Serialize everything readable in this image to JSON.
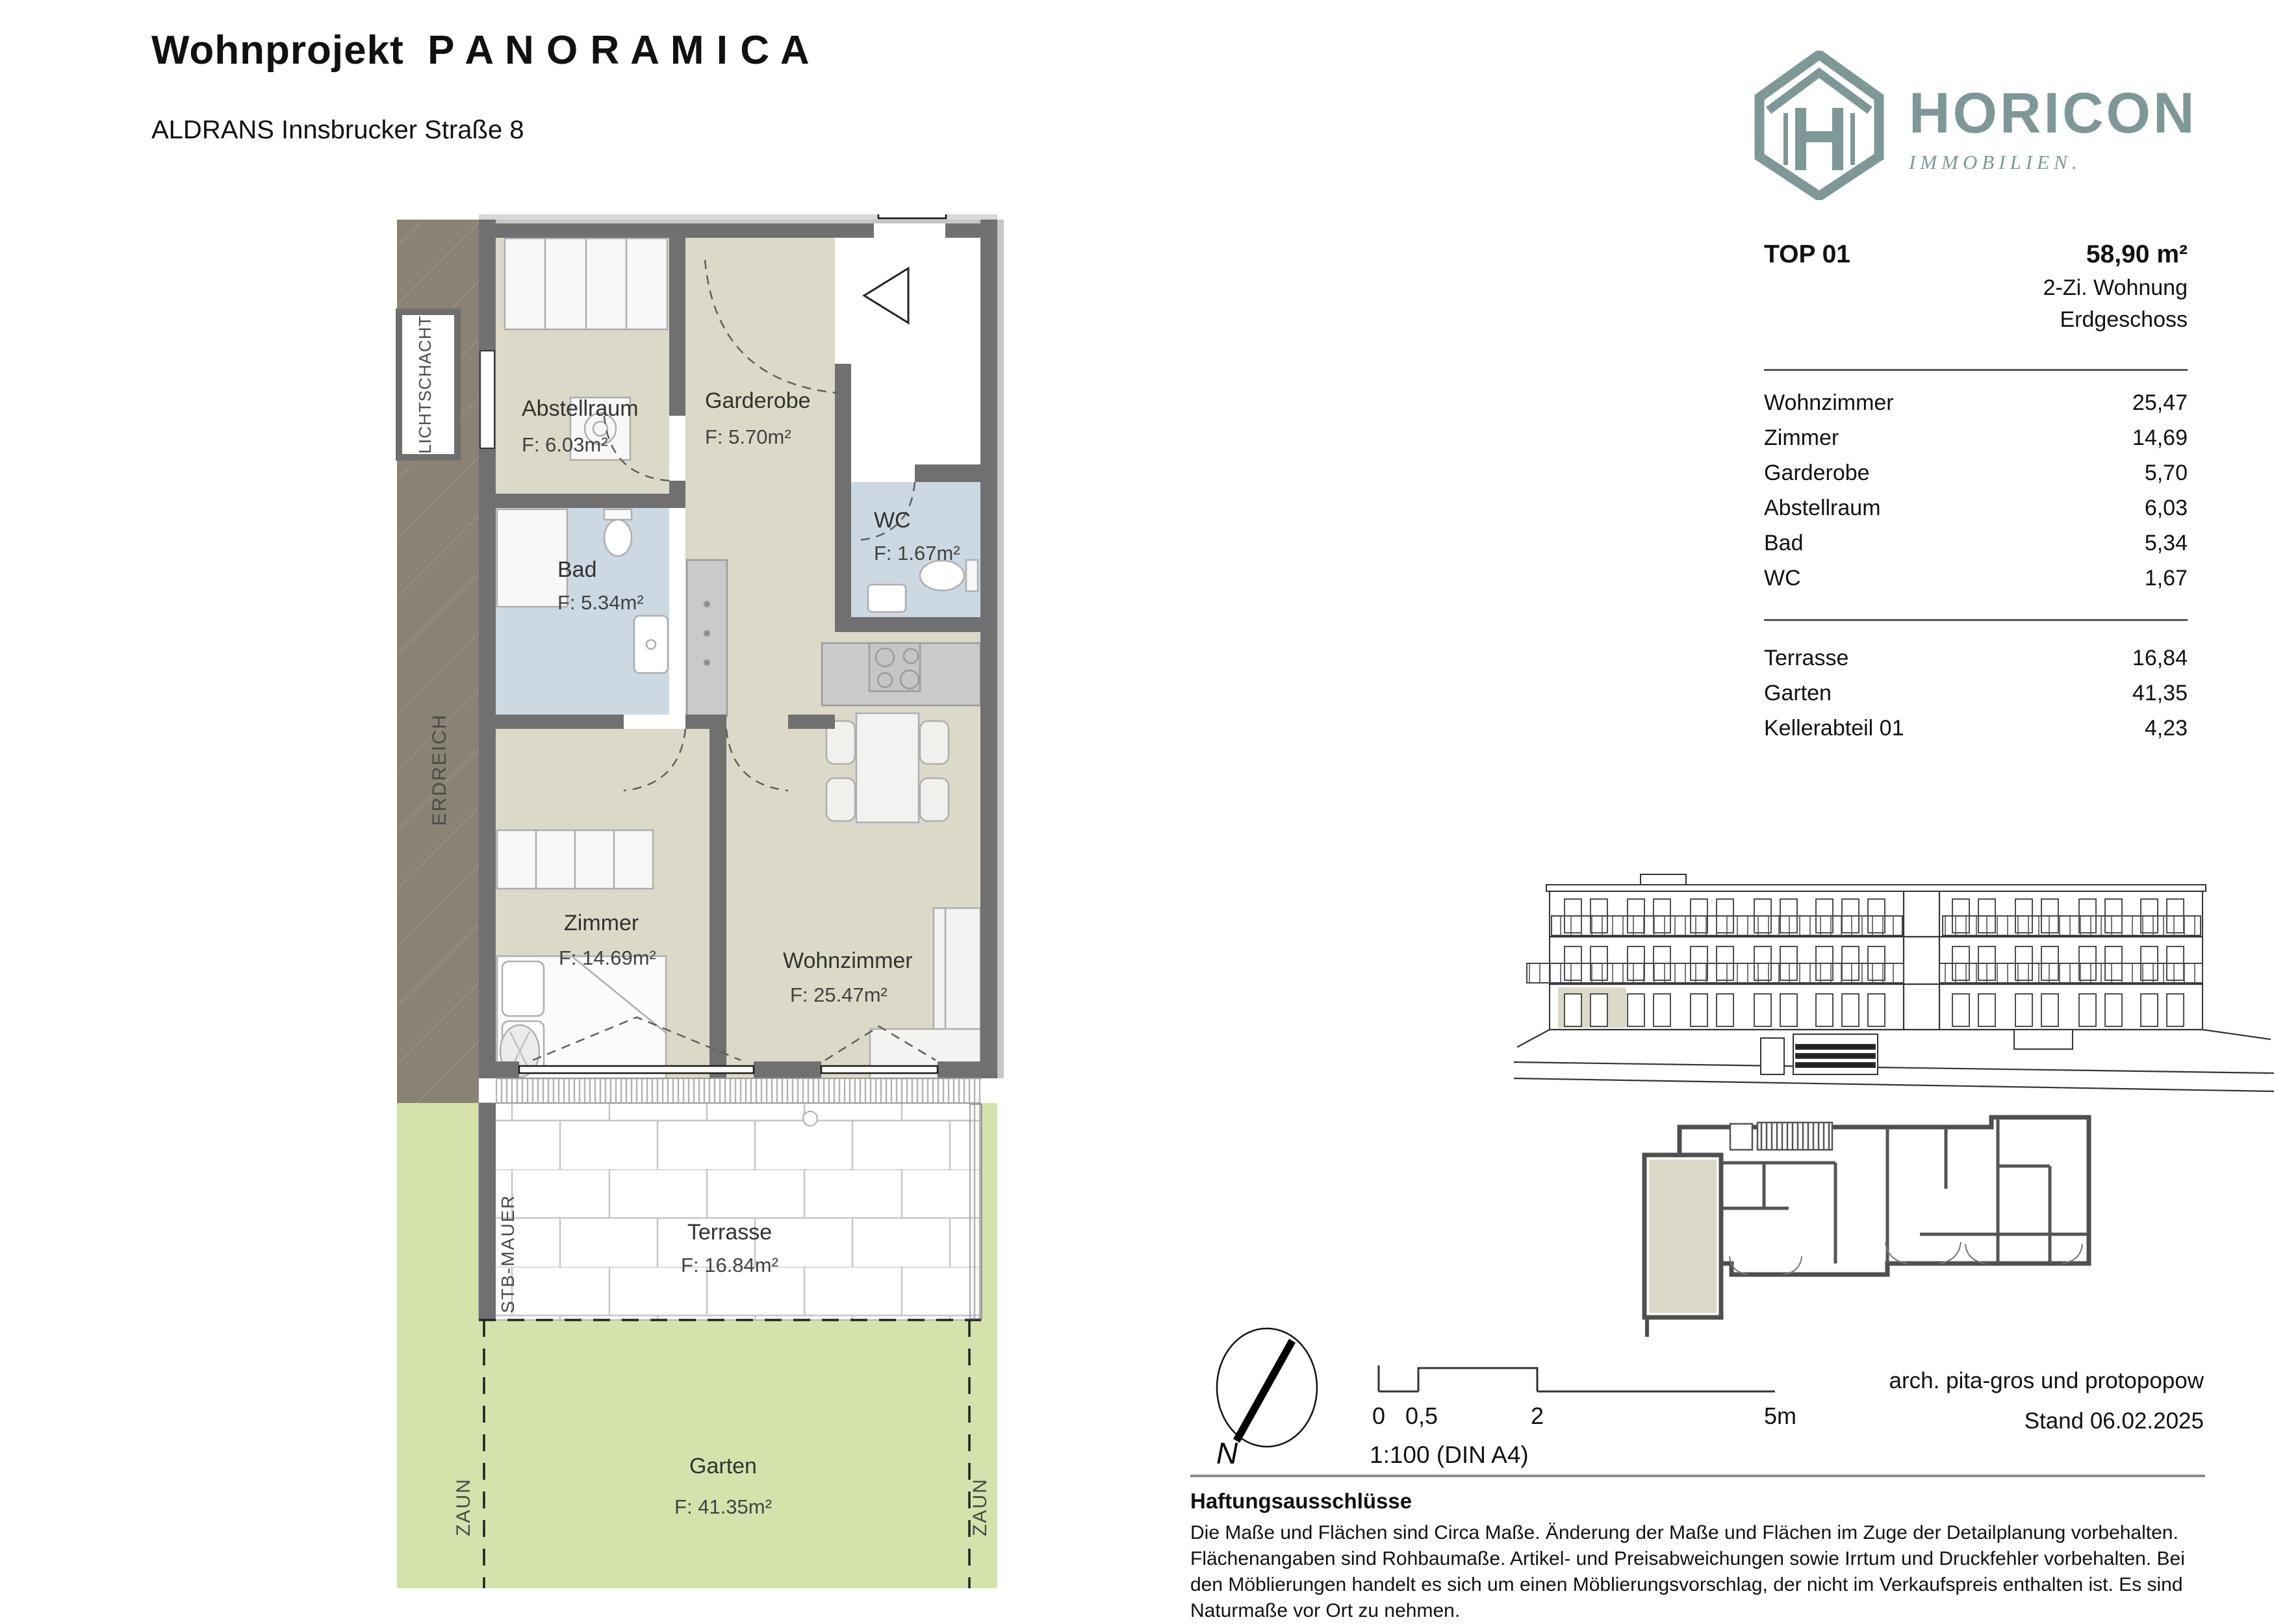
{
  "header": {
    "title": "Wohnprojekt  P A N O R A M I C A",
    "subtitle": "ALDRANS Innsbrucker Straße 8"
  },
  "logo": {
    "name": "HORICON",
    "tagline": "IMMOBILIEN.",
    "brand_color": "#7d9897"
  },
  "unit_panel": {
    "unit": "TOP 01",
    "total_area": "58,90 m²",
    "type": "2-Zi. Wohnung",
    "floor": "Erdgeschoss",
    "rooms": [
      {
        "label": "Wohnzimmer",
        "value": "25,47"
      },
      {
        "label": "Zimmer",
        "value": "14,69"
      },
      {
        "label": "Garderobe",
        "value": "5,70"
      },
      {
        "label": "Abstellraum",
        "value": "6,03"
      },
      {
        "label": "Bad",
        "value": "5,34"
      },
      {
        "label": "WC",
        "value": "1,67"
      }
    ],
    "outdoor": [
      {
        "label": "Terrasse",
        "value": "16,84"
      },
      {
        "label": "Garten",
        "value": "41,35"
      },
      {
        "label": "Kellerabteil 01",
        "value": "4,23"
      }
    ]
  },
  "floor_plan": {
    "colors": {
      "room_beige": "#dcd9c8",
      "wet_blue": "#ccd8e2",
      "garden_green": "#d4e3ac",
      "earth_taupe": "#8a8273",
      "wall_gray": "#707070"
    },
    "rooms": [
      {
        "name": "Abstellraum",
        "area": "F:  6.03m²"
      },
      {
        "name": "Garderobe",
        "area": "F:  5.70m²"
      },
      {
        "name": "WC",
        "area": "F:  1.67m²"
      },
      {
        "name": "Bad",
        "area": "F:  5.34m²"
      },
      {
        "name": "Zimmer",
        "area": "F:  14.69m²"
      },
      {
        "name": "Wohnzimmer",
        "area": "F:  25.47m²"
      },
      {
        "name": "Terrasse",
        "area": "F:  16.84m²"
      },
      {
        "name": "Garten",
        "area": "F:  41.35m²"
      }
    ],
    "annotations": {
      "lichtschacht": "LICHTSCHACHT",
      "erdreich": "ERDREICH",
      "stb_mauer": "STB-MAUER",
      "zaun_left": "ZAUN",
      "zaun_right": "ZAUN"
    }
  },
  "footer": {
    "compass_label": "N",
    "scale": {
      "ticks": [
        "0",
        "0,5",
        "2",
        "5m"
      ],
      "note": "1:100 (DIN A4)"
    },
    "architect": "arch. pita-gros und protopopow",
    "date": "Stand 06.02.2025",
    "disclaimer_title": "Haftungsausschlüsse",
    "disclaimer_text": "Die Maße und Flächen sind Circa Maße. Änderung der Maße und Flächen im Zuge der Detailplanung vorbehalten. Flächenangaben sind Rohbaumaße. Artikel- und Preisabweichungen sowie Irrtum und Druckfehler vorbehalten. Bei den Möblierungen handelt es sich um einen Möblierungsvorschlag, der nicht im Verkaufspreis enthalten ist. Es sind Naturmaße vor Ort zu nehmen."
  }
}
